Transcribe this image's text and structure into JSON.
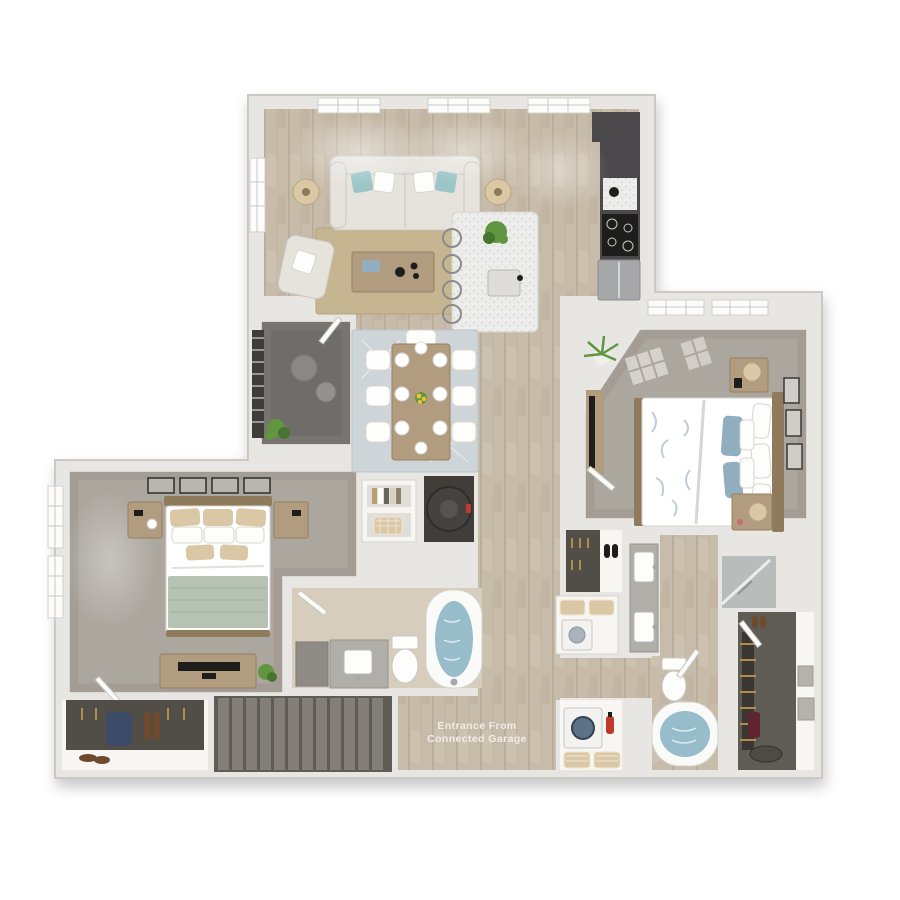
{
  "image_type": "3d-floor-plan-render",
  "entrance_label": {
    "line1": "Entrance From",
    "line2": "Connected Garage"
  },
  "palette": {
    "wall": "#e8e6e2",
    "wallEdge": "#d4d2cd",
    "wood": "#c7bba9",
    "woodDark": "#ab9d89",
    "woodLight": "#d6cdbc",
    "carpet": "#aba69e",
    "carpetShade": "#8f8a82",
    "denFloor": "#6f6d69",
    "closetDark": "#514d47",
    "walkinFloor": "#5f5b55",
    "cabinet": "#4a484a",
    "granite": "#b0aea8",
    "fabric": "#e6e3dd",
    "woodFurn": "#b29c80",
    "woodFurnDark": "#8f7a5b",
    "teal": "#9cc5c8",
    "blue": "#91aebf",
    "sage": "#b6c2b2",
    "tan": "#d9c7a5",
    "jute": "#c6b591",
    "diningRug": "#ced5d9",
    "water": "#97bcca",
    "stairTread": "#837e77",
    "stairGap": "#5f5b55",
    "plantGreen": "#61953f",
    "plantGreenDark": "#47742e",
    "red": "#c0392b",
    "gold": "#b08d4f",
    "navy": "#3c4b68",
    "brown": "#6f4b2e",
    "textLight": "#f1eee8"
  },
  "rooms": [
    "living-room",
    "kitchen",
    "dining-area",
    "den",
    "bedroom-1",
    "bedroom-2",
    "bathroom-1",
    "bathroom-2",
    "walk-in-closet",
    "laundry-closet",
    "entry-hall",
    "stairs",
    "storage-closet",
    "water-heater-closet",
    "linen-shelves"
  ]
}
